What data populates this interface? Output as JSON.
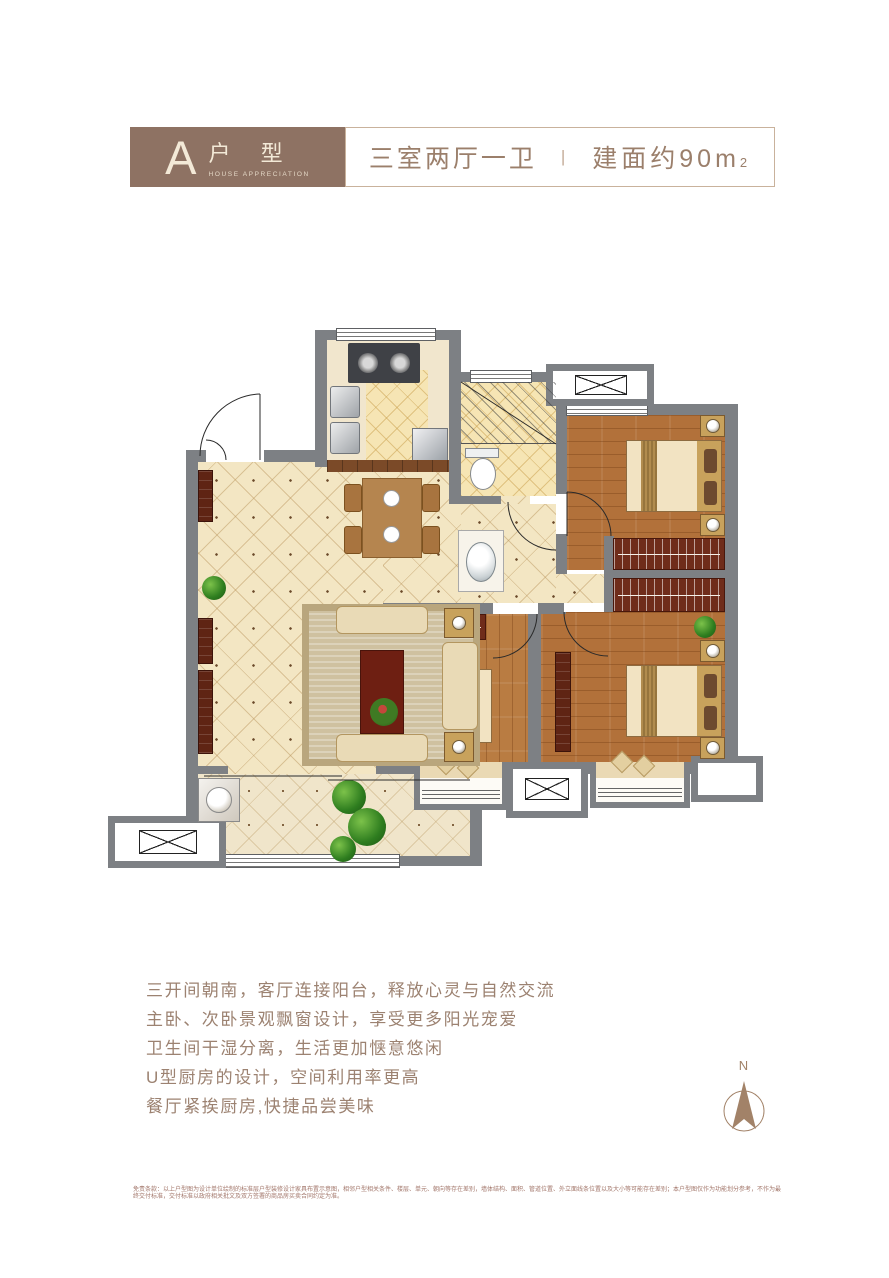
{
  "header": {
    "type_letter": "A",
    "type_label": "户 型",
    "type_sub": "HOUSE APPRECIATION",
    "layout": "三室两厅一卫",
    "divider": "|",
    "area_label": "建面约90",
    "area_unit": "m",
    "area_sup": "2"
  },
  "features": {
    "lines": [
      "三开间朝南，客厅连接阳台，释放心灵与自然交流",
      "主卧、次卧景观飘窗设计，享受更多阳光宠爱",
      "卫生间干湿分离，生活更加惬意悠闲",
      "U型厨房的设计，空间利用率更高",
      "餐厅紧挨厨房,快捷品尝美味"
    ]
  },
  "compass": {
    "label": "N"
  },
  "disclaimer": "免责条款：以上户型图为设计单位绘制的标准层户型装修设计家具布置示意图，相邻户型相关条件、楼层、单元、朝向等存在差别，墙体结构、面积、管道位置、外立面线条位置以及大小等可能存在差别；本户型图仅作为功能划分参考，不作为最终交付标准，交付标准以政府相关批文及双方签署的商品房买卖合同约定为准。",
  "colors": {
    "wall": "#7d8084",
    "header_brown": "#8e7263",
    "spec_border": "#c9b29c",
    "text_brown": "#9c8271",
    "tile": "#f3e6c3",
    "wood": "#b2713a",
    "closet": "#6f2c1a",
    "disclaimer_red": "#a2766a"
  }
}
